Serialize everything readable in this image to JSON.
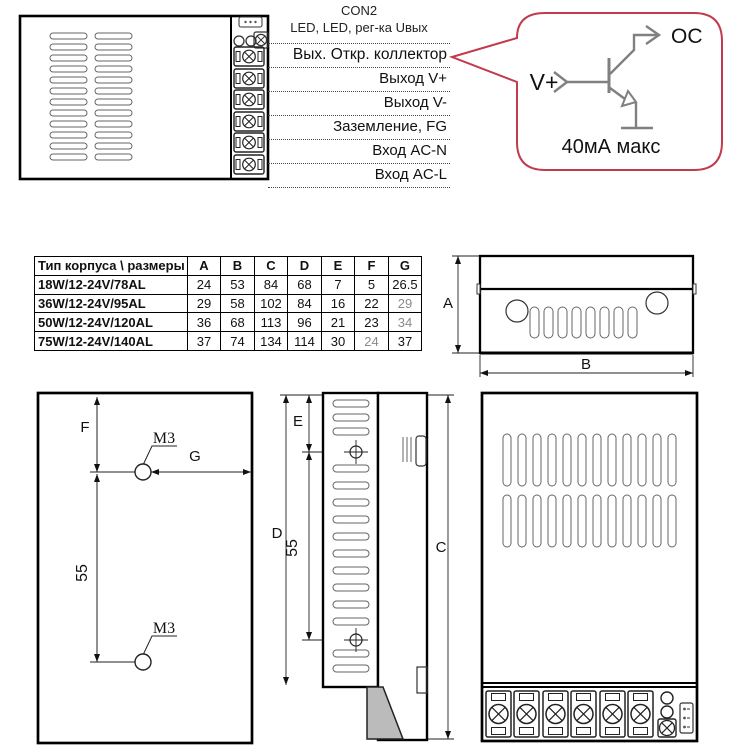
{
  "pin_labels": {
    "con2": "CON2",
    "subtitle": "LED, LED,  рег-ка Uвых",
    "rows": [
      "Вых. Откр. коллектор",
      "Выход V+",
      "Выход V-",
      "Заземление, FG",
      "Вход AC-N",
      "Вход  AC-L"
    ]
  },
  "callout": {
    "input_label": "V+",
    "output_label": "OC",
    "current_note": "40мА макс"
  },
  "dimensions_table": {
    "header_label": "Тип корпуса \\ размеры",
    "cols": [
      "A",
      "B",
      "C",
      "D",
      "E",
      "F",
      "G"
    ],
    "rows": [
      {
        "label": "18W/12-24V/78AL",
        "values": [
          "24",
          "53",
          "84",
          "68",
          "7",
          "5",
          "26.5"
        ]
      },
      {
        "label": "36W/12-24V/95AL",
        "values": [
          "29",
          "58",
          "102",
          "84",
          "16",
          "22",
          "29"
        ]
      },
      {
        "label": "50W/12-24V/120AL",
        "values": [
          "36",
          "68",
          "113",
          "96",
          "21",
          "23",
          "34"
        ]
      },
      {
        "label": "75W/12-24V/140AL",
        "values": [
          "37",
          "74",
          "134",
          "114",
          "30",
          "24",
          "37"
        ]
      }
    ]
  },
  "side_view": {
    "dim_a": "A",
    "dim_b": "B"
  },
  "mounting_view": {
    "dim_f": "F",
    "dim_g": "G",
    "hole_spacing": "55",
    "thread": "M3"
  },
  "profile_view": {
    "dim_c": "C",
    "dim_d": "D",
    "dim_e": "E",
    "hole_spacing": "55"
  },
  "colors": {
    "callout_red": "#c23b4c",
    "schematic_gray": "#808080",
    "foot_gray": "#bbbbbb"
  }
}
